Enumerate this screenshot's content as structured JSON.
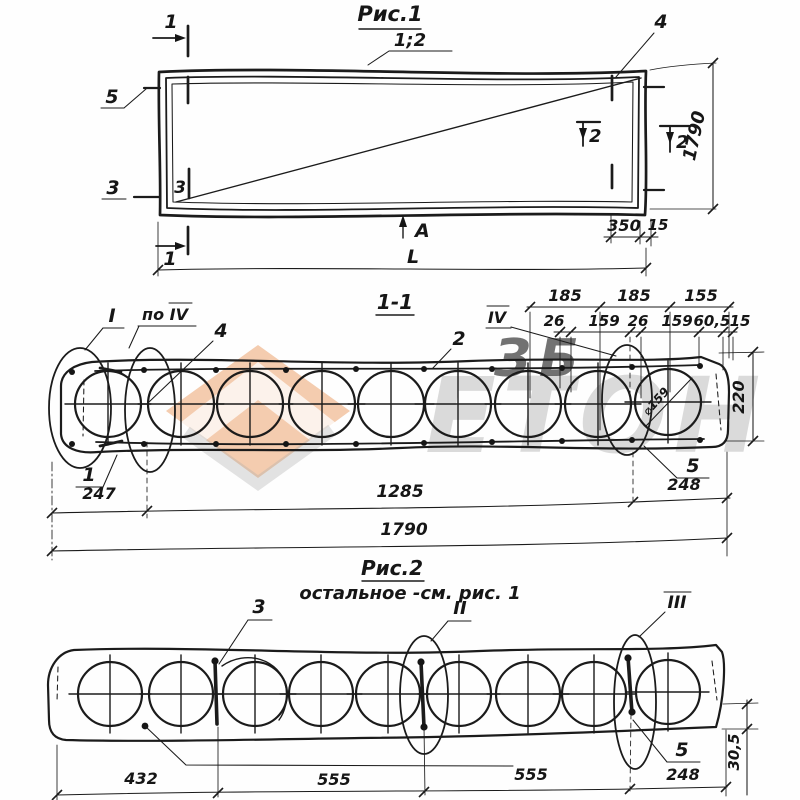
{
  "fig1": {
    "title": "Рис.1",
    "callout": "1;2",
    "mark1_top": "1",
    "mark1_bottom": "1",
    "mark2_inner": "2",
    "mark2_outer": "2",
    "mark3_left": "3",
    "mark3_inner": "3",
    "mark4": "4",
    "mark5": "5",
    "view_label": "A",
    "length_label": "L",
    "dim_350": "350",
    "dim_15": "15",
    "dim_1790": "1790"
  },
  "section11": {
    "title": "1-1",
    "detail_I": "I",
    "detail_po_IV": "по IV",
    "detail_IV": "IV",
    "pos_1": "1",
    "pos_2": "2",
    "pos_4": "4",
    "pos_5": "5",
    "core_diameter": "⌀159",
    "dims_top": [
      "185",
      "185",
      "155"
    ],
    "dims_mid": [
      "26",
      "159",
      "26",
      "159",
      "60,5",
      "15"
    ],
    "dim_height": "220",
    "dim_247": "247",
    "dim_1285": "1285",
    "dim_248": "248",
    "dim_total": "1790"
  },
  "fig2": {
    "title": "Рис.2",
    "note": "остальное -см. рис. 1",
    "pos_3": "3",
    "detail_II": "II",
    "detail_III": "III",
    "pos_5": "5",
    "dim_flange": "30,5",
    "dims_bottom": [
      "432",
      "555",
      "555",
      "248"
    ]
  },
  "watermark": {
    "big_text": "ЕТОН",
    "small_text": "ЗБ"
  }
}
